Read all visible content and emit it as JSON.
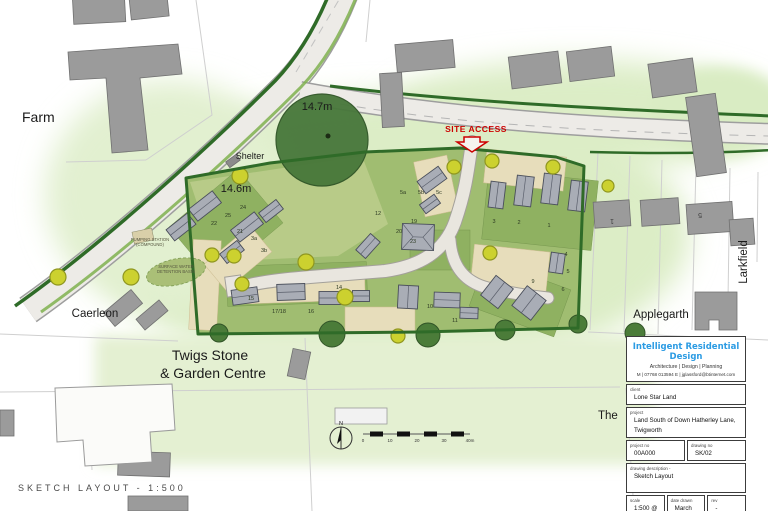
{
  "page": {
    "footer": "SKETCH LAYOUT - 1:500"
  },
  "map_labels": {
    "farm": "Farm",
    "shelter": "Shelter",
    "spot_height_top": "14.7m",
    "spot_height_mid": "14.6m",
    "site_access": "SITE ACCESS",
    "caerleon": "Caerleon",
    "garden_centre_line1": "Twigs Stone",
    "garden_centre_line2": "& Garden Centre",
    "applegarth": "Applegarth",
    "larkfield": "Larkfield",
    "the_partial": "The",
    "pumping_line1": "PUMPING STATION",
    "pumping_line2": "(COMPOUND)",
    "basin_line1": "SURFACE WATER",
    "basin_line2": "DETENTION BASIN",
    "north": "N"
  },
  "scale_bar": {
    "ticks": [
      "0",
      "10",
      "20",
      "30",
      "40m"
    ]
  },
  "site_plan": {
    "plot_numbers": [
      {
        "n": "24",
        "x": 243,
        "y": 209
      },
      {
        "n": "25",
        "x": 228,
        "y": 217
      },
      {
        "n": "22",
        "x": 214,
        "y": 225
      },
      {
        "n": "21",
        "x": 240,
        "y": 233
      },
      {
        "n": "3a",
        "x": 254,
        "y": 240
      },
      {
        "n": "3b",
        "x": 264,
        "y": 252
      },
      {
        "n": "12",
        "x": 378,
        "y": 215
      },
      {
        "n": "5a",
        "x": 403,
        "y": 194
      },
      {
        "n": "5b",
        "x": 421,
        "y": 194
      },
      {
        "n": "5c",
        "x": 439,
        "y": 194
      },
      {
        "n": "19",
        "x": 414,
        "y": 223
      },
      {
        "n": "20",
        "x": 399,
        "y": 233
      },
      {
        "n": "23",
        "x": 413,
        "y": 243
      },
      {
        "n": "3",
        "x": 494,
        "y": 223
      },
      {
        "n": "2",
        "x": 519,
        "y": 224
      },
      {
        "n": "1",
        "x": 549,
        "y": 227
      },
      {
        "n": "4",
        "x": 566,
        "y": 256
      },
      {
        "n": "5",
        "x": 568,
        "y": 273
      },
      {
        "n": "6",
        "x": 563,
        "y": 291
      },
      {
        "n": "9",
        "x": 533,
        "y": 283
      },
      {
        "n": "14",
        "x": 339,
        "y": 289
      },
      {
        "n": "15",
        "x": 251,
        "y": 300
      },
      {
        "n": "17/18",
        "x": 279,
        "y": 313
      },
      {
        "n": "16",
        "x": 311,
        "y": 313
      },
      {
        "n": "10",
        "x": 430,
        "y": 308
      },
      {
        "n": "11",
        "x": 455,
        "y": 322
      }
    ],
    "context_numbers": [
      {
        "n": "1",
        "x": 612,
        "y": 219,
        "rot": 180
      },
      {
        "n": "5",
        "x": 700,
        "y": 213,
        "rot": 180
      }
    ]
  },
  "title_block": {
    "company": "Intelligent Residential Design",
    "tagline": "Architecture | Design | Planning",
    "contact": "M | 07768 013594  E | jglassford@btinternet.com",
    "client_label": "client",
    "client": "Lone Star Land",
    "project_label": "project",
    "project_line1": "Land South of Down Hatherley Lane,",
    "project_line2": "Twigworth",
    "project_no_label": "project no",
    "project_no": "00A000",
    "drawing_no_label": "drawing no",
    "drawing_no": "SK/02",
    "description_label": "drawing description -",
    "description": "Sketch Layout",
    "scale_label": "scale",
    "scale": "1:500 @ A2",
    "date_label": "date drawn",
    "date": "March 2019",
    "rev_label": "rev",
    "rev": "-"
  },
  "colors": {
    "site_access_red": "#cc0000",
    "company_blue": "#2b9be3",
    "tree_yellow": "#ccd12f",
    "tree_dark": "#4b7c39",
    "hedge_green": "#2f6b28",
    "garden_green": "#9fbc6f"
  }
}
